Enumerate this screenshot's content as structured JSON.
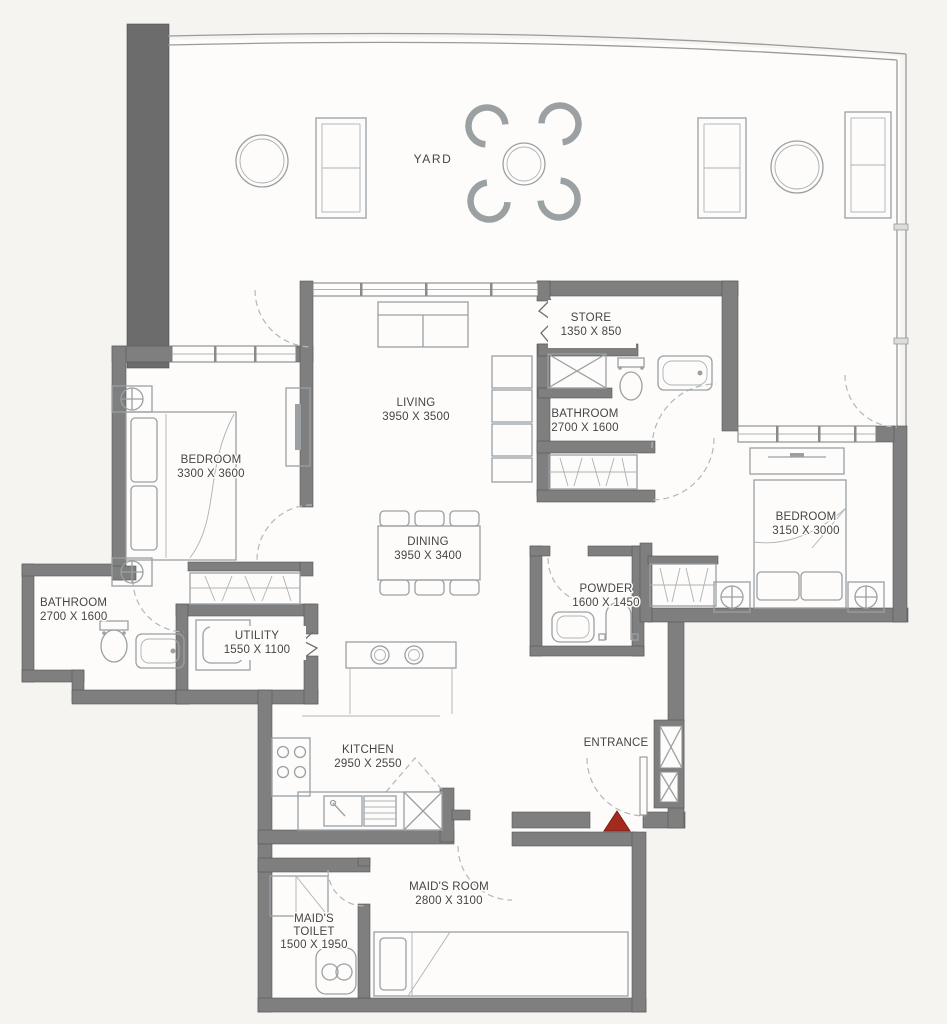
{
  "plan_title": "Apartment Floor Plan",
  "colors": {
    "wall": "#7f7f7f",
    "wall_dark": "#6c6c6c",
    "furniture_line": "#9ba0a3",
    "door_dash": "#b4b7b9",
    "label_text": "#454545",
    "floor": "#fdfcfa",
    "background": "#f5f4f1",
    "entrance_marker": "#a32a1e"
  },
  "rooms": {
    "yard": {
      "name": "YARD"
    },
    "living": {
      "name": "LIVING",
      "dims": "3950 X 3500"
    },
    "store": {
      "name": "STORE",
      "dims": "1350 X 850"
    },
    "bathroom_top": {
      "name": "BATHROOM",
      "dims": "2700 X 1600"
    },
    "bedroom_left": {
      "name": "BEDROOM",
      "dims": "3300 X 3600"
    },
    "bedroom_right": {
      "name": "BEDROOM",
      "dims": "3150 X 3000"
    },
    "dining": {
      "name": "DINING",
      "dims": "3950 X 3400"
    },
    "powder": {
      "name": "POWDER",
      "dims": "1600 X 1450"
    },
    "bathroom_left": {
      "name": "BATHROOM",
      "dims": "2700 X 1600"
    },
    "utility": {
      "name": "UTILITY",
      "dims": "1550 X 1100"
    },
    "kitchen": {
      "name": "KITCHEN",
      "dims": "2950 X 2550"
    },
    "entrance": {
      "name": "ENTRANCE"
    },
    "maids_room": {
      "name": "MAID'S ROOM",
      "dims": "2800 X 3100"
    },
    "maids_toilet": {
      "name_line1": "MAID'S",
      "name_line2": "TOILET",
      "dims": "1500 X 1950"
    }
  }
}
